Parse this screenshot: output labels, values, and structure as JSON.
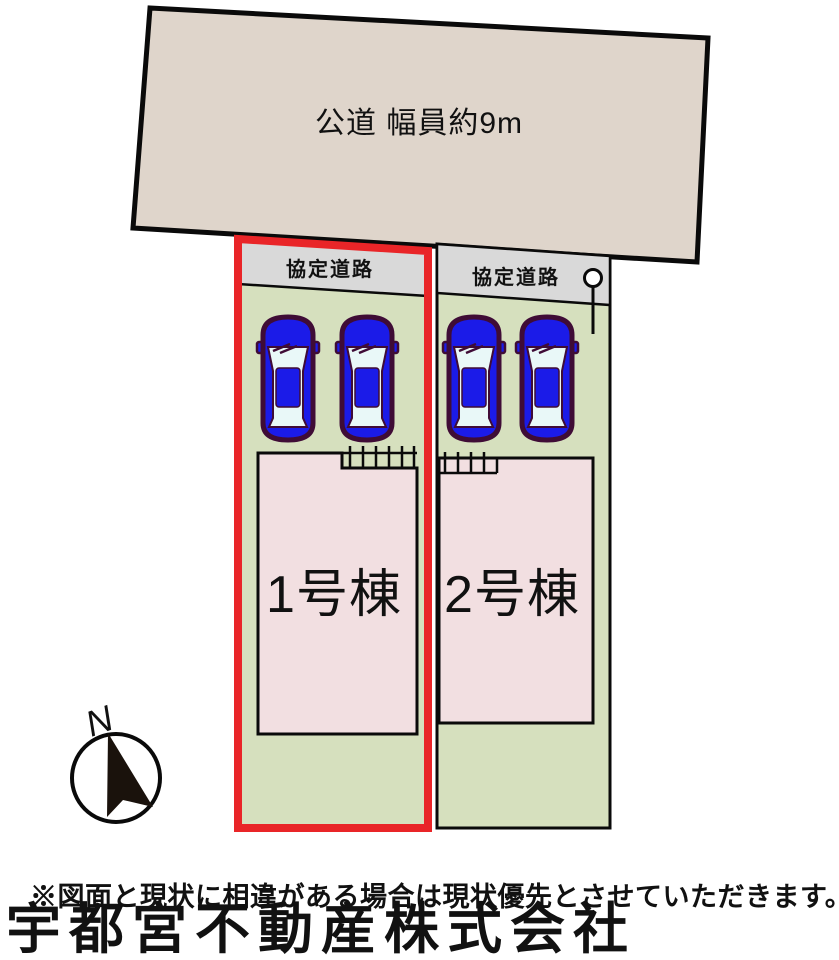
{
  "diagram": {
    "road": {
      "label": "公道 幅員約9m"
    },
    "plots": [
      {
        "id": "1",
        "agreement_road_label": "協定道路",
        "building_label": "1号棟",
        "highlighted": true,
        "cars": 2
      },
      {
        "id": "2",
        "agreement_road_label": "協定道路",
        "building_label": "2号棟",
        "highlighted": false,
        "cars": 2
      }
    ],
    "compass": {
      "label": "N"
    },
    "icons": {
      "car": "car-icon",
      "compass": "north-compass-icon",
      "pole": "utility-pole-icon"
    }
  },
  "footer": {
    "disclaimer": "※図面と現状に相違がある場合は現状優先とさせていただきます。",
    "watermark": "宇都宮不動産株式会社"
  },
  "colors": {
    "road_fill": "#DFD5CB",
    "strip_fill": "#D9D9D9",
    "plot_fill": "#D6E0BE",
    "building_fill": "#F2DFE1",
    "car_fill": "#1B1BE8",
    "car_outline": "#3F0C36",
    "car_window": "#E9F8F8",
    "highlight_red": "#E92528",
    "watermark_gray": "#8C8C8C",
    "outline_black": "#0A0A0A"
  }
}
